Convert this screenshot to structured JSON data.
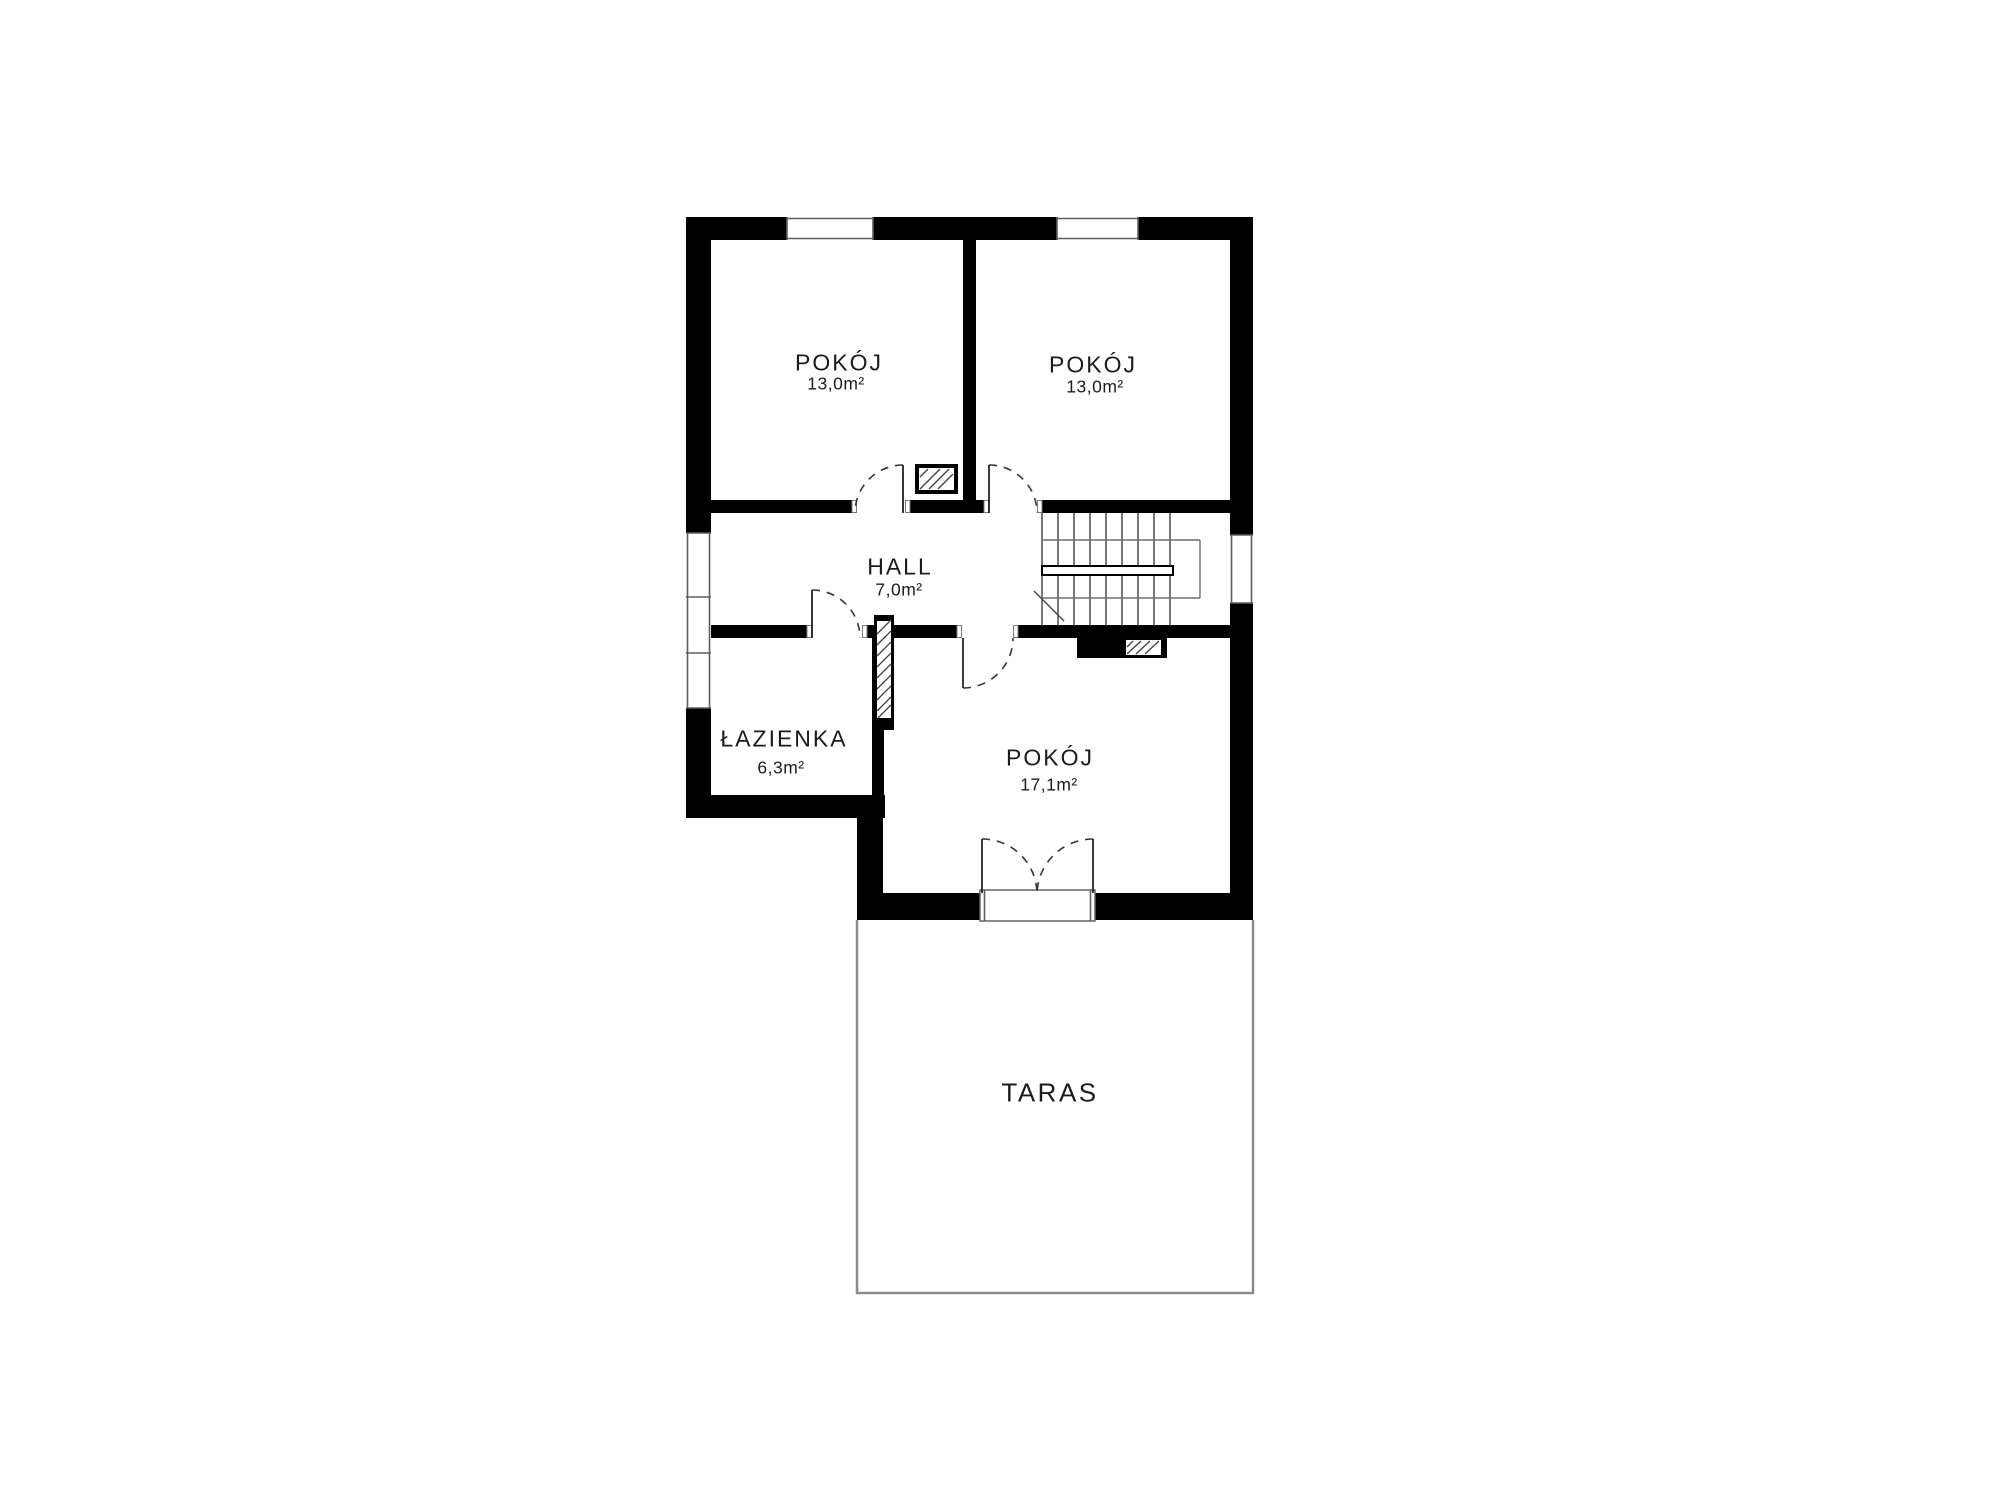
{
  "plan_title": "floor-plan",
  "colors": {
    "wall": "#000000",
    "thin_line": "#4a4a4a",
    "terrace_line": "#8a8a8a",
    "text": "#1b1b1b",
    "background": "#ffffff"
  },
  "rooms": [
    {
      "name": "POKÓJ",
      "area": "13,0m²"
    },
    {
      "name": "POKÓJ",
      "area": "13,0m²"
    },
    {
      "name": "HALL",
      "area": "7,0m²"
    },
    {
      "name": "ŁAZIENKA",
      "area": "6,3m²"
    },
    {
      "name": "POKÓJ",
      "area": "17,1m²"
    },
    {
      "name": "TARAS",
      "area": ""
    }
  ]
}
